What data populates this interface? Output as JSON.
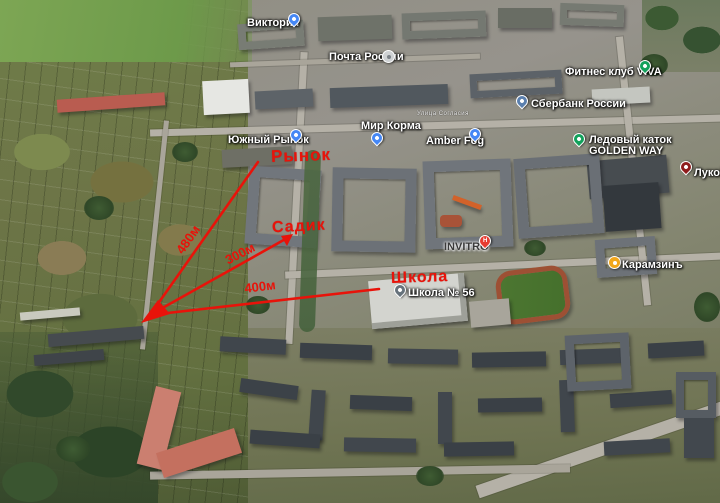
{
  "map": {
    "street_label": "Улица Согласия",
    "pois": [
      {
        "label": "Виктория",
        "icon": "shopping-pin"
      },
      {
        "label": "Почта России",
        "icon": "post-office-icon"
      },
      {
        "label": "Мир Корма",
        "icon": "shopping-pin"
      },
      {
        "label": "Amber Fog",
        "icon": "lock-pin"
      },
      {
        "label": "Сбербанк России",
        "icon": "bank-pin"
      },
      {
        "label": "Фитнес клуб VIVA",
        "icon": "fitness-pin"
      },
      {
        "label": "Ледовый каток",
        "label2": "GOLDEN WAY",
        "icon": "ice-rink-pin"
      },
      {
        "label": "Лукой",
        "icon": "fuel-pin"
      },
      {
        "label": "Карамзинъ",
        "icon": "restaurant-icon"
      },
      {
        "label": "INVITRO",
        "icon": "clinic-pin",
        "glyph": "H"
      },
      {
        "label": "Школа № 56",
        "icon": "school-pin"
      },
      {
        "label": "Южный Рынок",
        "icon": "shopping-pin"
      }
    ]
  },
  "annotations": {
    "color": "#e8130a",
    "market_label": "Рынок",
    "kindergarten_label": "Садик",
    "school_label": "Школа",
    "market_distance": "480м",
    "kindergarten_distance": "300м",
    "school_distance": "400м"
  },
  "pin_colors": {
    "blue": "#4587f5",
    "green": "#12a15b",
    "red": "#e63c31",
    "maroon": "#8e1b1b",
    "slate": "#5a7fae",
    "grey": "#66727b",
    "yellow": "#f2a71b",
    "post_grey": "#cfd2d4"
  }
}
